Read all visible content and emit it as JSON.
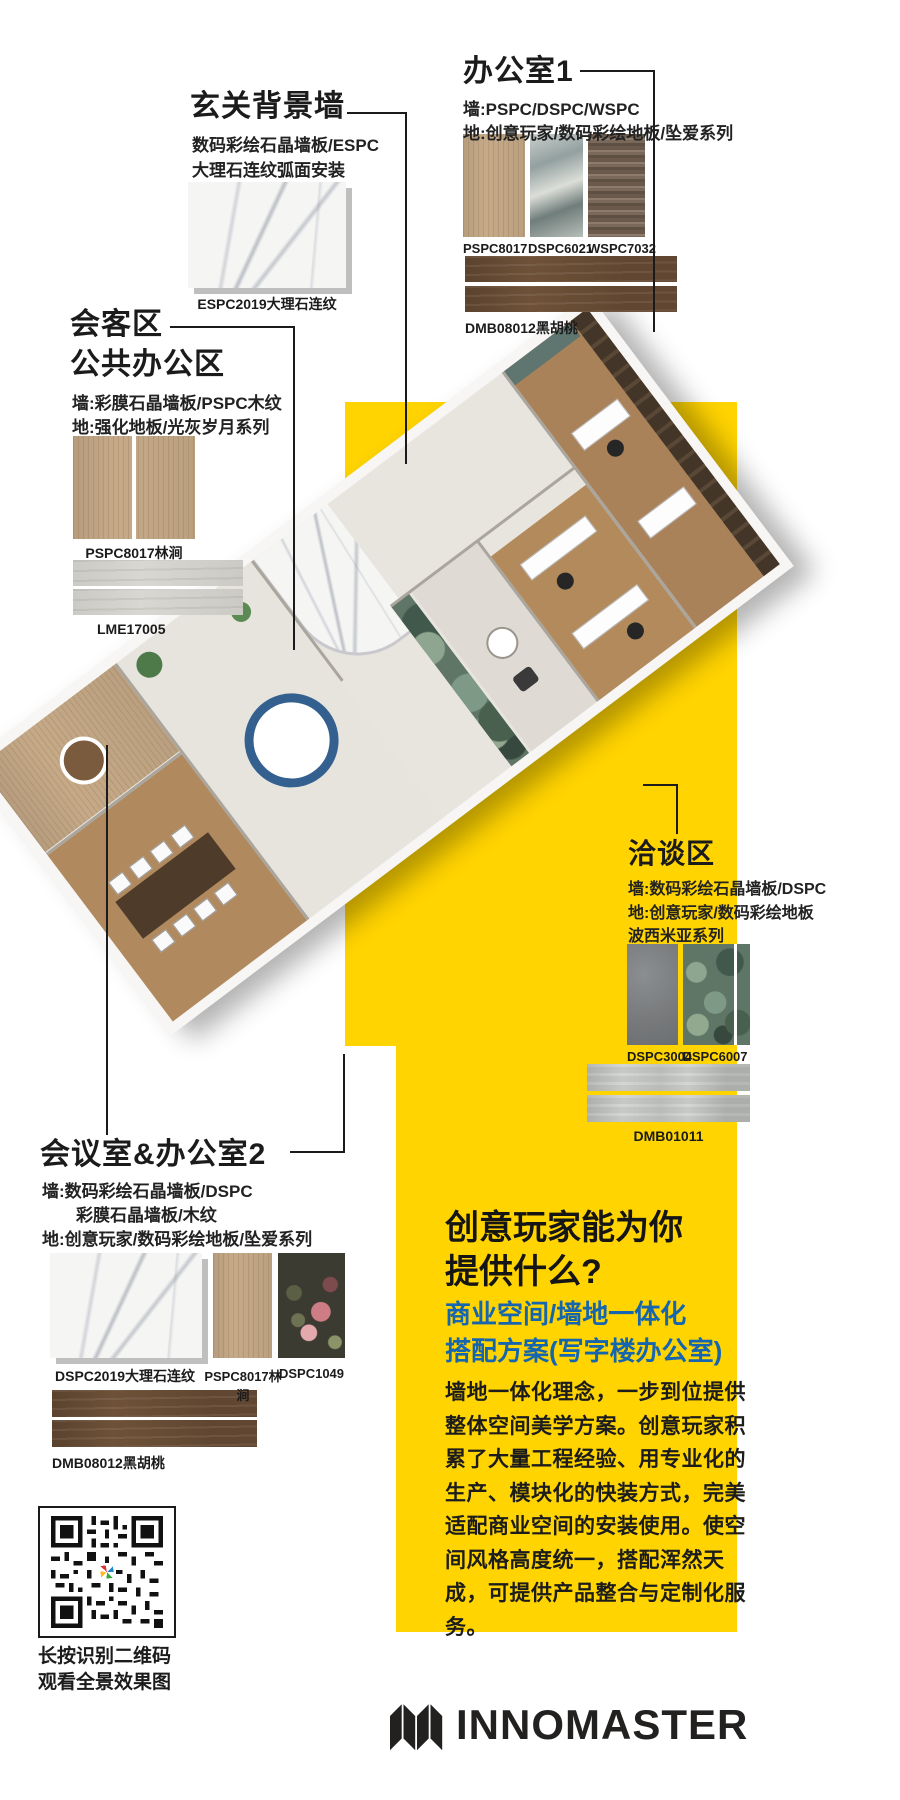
{
  "poster": {
    "bg": "#ffffff",
    "yellow": "#FFD401",
    "blue": "#1565AF",
    "ink": "#1B1B1B"
  },
  "entrance": {
    "title": "玄关背景墙",
    "desc_line1": "数码彩绘石晶墙板/ESPC",
    "desc_line2": "大理石连纹弧面安装",
    "swatch_label": "ESPC2019大理石连纹"
  },
  "office1": {
    "title": "办公室1",
    "wall": "墙:PSPC/DSPC/WSPC",
    "floor": "地:创意玩家/数码彩绘地板/坠爱系列",
    "swatch_labels": [
      "PSPC8017",
      "DSPC6021",
      "WSPC7032"
    ],
    "plank_label": "DMB08012黑胡桃"
  },
  "reception": {
    "title_line1": "会客区",
    "title_line2": "公共办公区",
    "wall": "墙:彩膜石晶墙板/PSPC木纹",
    "floor": "地:强化地板/光灰岁月系列",
    "panel_label": "PSPC8017林涧",
    "plank_label": "LME17005"
  },
  "negotiation": {
    "title": "洽谈区",
    "wall": "墙:数码彩绘石晶墙板/DSPC",
    "floor_line1": "地:创意玩家/数码彩绘地板",
    "floor_line2": "波西米亚系列",
    "swatch_labels": [
      "DSPC3004",
      "DSPC6007"
    ],
    "plank_label": "DMB01011"
  },
  "conference": {
    "title": "会议室&办公室2",
    "wall_line1": "墙:数码彩绘石晶墙板/DSPC",
    "wall_line2": "彩膜石晶墙板/木纹",
    "floor": "地:创意玩家/数码彩绘地板/坠爱系列",
    "swatch_labels": [
      "DSPC2019大理石连纹",
      "PSPC8017林涧",
      "DSPC1049"
    ],
    "plank_label": "DMB08012黑胡桃"
  },
  "promo": {
    "heading_line1": "创意玩家能为你",
    "heading_line2": "提供什么?",
    "subheading_line1": "商业空间/墙地一体化",
    "subheading_line2": "搭配方案(写字楼办公室)",
    "body": "墙地一体化理念，一步到位提供整体空间美学方案。创意玩家积累了大量工程经验、用专业化的生产、模块化的快装方式，完美适配商业空间的安装使用。使空间风格高度统一，搭配浑然天成，可提供产品整合与定制化服务。"
  },
  "qr": {
    "caption_line1": "长按识别二维码",
    "caption_line2": "观看全景效果图"
  },
  "brand": {
    "name": "INNOMASTER"
  }
}
